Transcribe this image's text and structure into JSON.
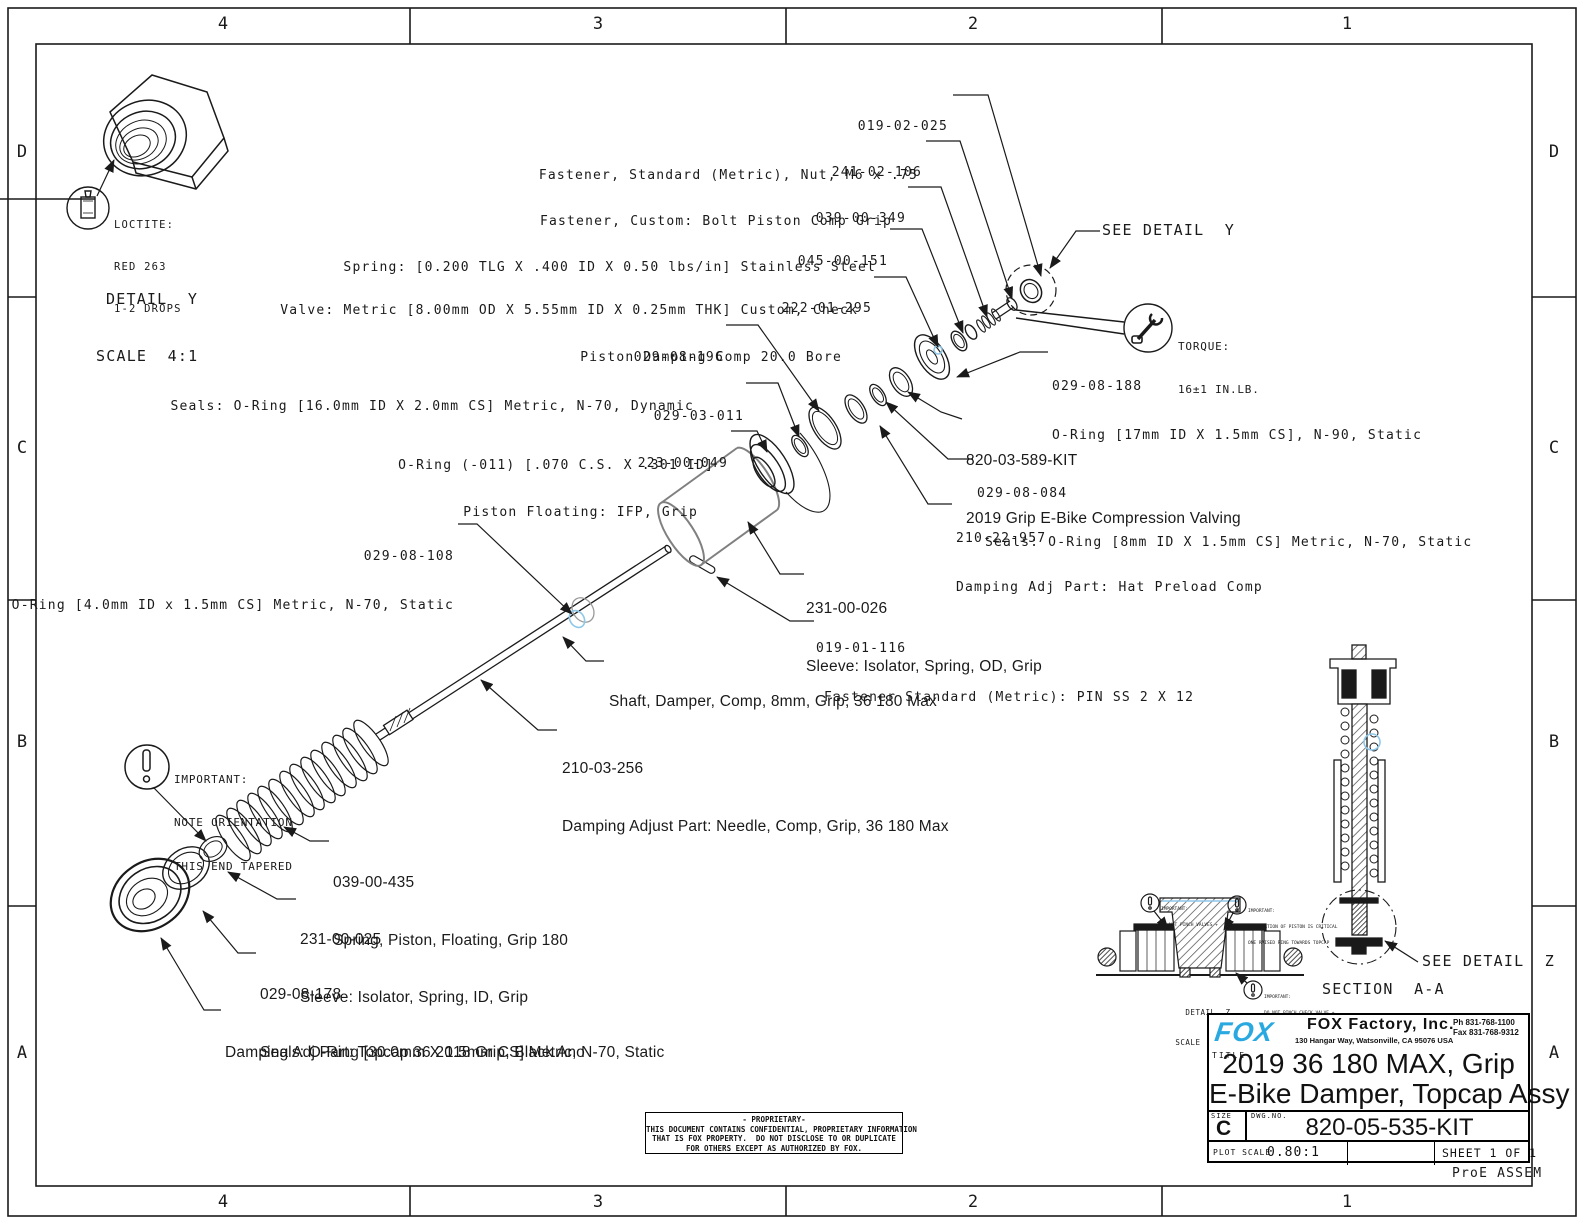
{
  "sheet": {
    "zone_columns": [
      "4",
      "3",
      "2",
      "1"
    ],
    "zone_rows": [
      "D",
      "C",
      "B",
      "A"
    ],
    "footer_note": "ProE ASSEM"
  },
  "colors": {
    "fox_blue": "#2aa9e0",
    "highlight_blue": "#8fc7e8",
    "line": "#1a1a1a"
  },
  "callouts": {
    "nut_m6": {
      "num": "019-02-025",
      "desc": "Fastener, Standard (Metric), Nut, M6 x .75"
    },
    "bolt_piston": {
      "num": "241-02-106",
      "desc": "Fastener, Custom: Bolt Piston Comp Grip"
    },
    "spring_check": {
      "num": "039-00-349",
      "desc": "Spring: [0.200 TLG X .400 ID X 0.50 lbs/in] Stainless Steel"
    },
    "valve_check": {
      "num": "045-00-151",
      "desc": "Valve: Metric [8.00mm OD X 5.55mm ID X 0.25mm THK] Custom, Check"
    },
    "piston_damping": {
      "num": "222-01-295",
      "desc": "Piston Damping Comp 20.0 Bore"
    },
    "oring_16": {
      "num": "029-08-196",
      "desc": "Seals: O-Ring [16.0mm ID X 2.0mm CS] Metric, N-70, Dynamic"
    },
    "oring_011": {
      "num": "029-03-011",
      "desc": "O-Ring (-011) [.070 C.S. X .301 ID]"
    },
    "piston_floating": {
      "num": "223-00-049",
      "desc": "Piston Floating: IFP, Grip"
    },
    "oring_17": {
      "num": "029-08-188",
      "desc": "O-Ring [17mm ID X 1.5mm CS], N-90, Static"
    },
    "comp_valving": {
      "num": "820-03-589-KIT",
      "desc": "2019 Grip E-Bike Compression Valving"
    },
    "oring_8": {
      "num": "029-08-084",
      "desc": "Seals: O-Ring [8mm ID X 1.5mm CS] Metric, N-70, Static"
    },
    "hat_preload": {
      "num": "210-22-957",
      "desc": "Damping Adj Part: Hat Preload Comp"
    },
    "oring_4": {
      "num": "029-08-108",
      "desc": "Seals: O-Ring [4.0mm ID x 1.5mm CS] Metric, N-70, Static"
    },
    "sleeve_od": {
      "num": "231-00-026",
      "desc": "Sleeve: Isolator, Spring, OD, Grip"
    },
    "pin": {
      "num": "019-01-116",
      "desc": "Fastener Standard (Metric): PIN SS 2 X 12"
    },
    "shaft": {
      "desc": "Shaft, Damper, Comp, 8mm, Grip, 36 180 Max"
    },
    "needle": {
      "num": "210-03-256",
      "desc": "Damping Adjust Part: Needle, Comp, Grip, 36 180 Max"
    },
    "spring_piston": {
      "num": "039-00-435",
      "desc": "Spring, Piston, Floating, Grip 180"
    },
    "sleeve_id": {
      "num": "231-00-025",
      "desc": "Sleeve: Isolator, Spring, ID, Grip"
    },
    "oring_30": {
      "num": "029-08-178",
      "desc": "Seals: O-Ring [30.0mm X 1.5mm CS] Metric, N-70, Static"
    },
    "topcap": {
      "desc": "Damping Adj Part: Topcap 36 2018 Grip, Black Ano"
    }
  },
  "notes": {
    "see_detail_y": "SEE DETAIL  Y",
    "see_detail_z": "SEE DETAIL  Z",
    "section_aa": "SECTION  A-A",
    "torque": {
      "line1": "TORQUE:",
      "line2": "16±1 IN.LB."
    },
    "loctite": {
      "line1": "LOCTITE:",
      "line2": "RED 263",
      "line3": "1-2 DROPS"
    },
    "detail_y": {
      "line1": "DETAIL  Y",
      "line2": "SCALE  4:1"
    },
    "detail_z": {
      "line1": "DETAIL  Z",
      "line2": "SCALE  10.000"
    },
    "important_taper": {
      "line1": "IMPORTANT:",
      "line2": "NOTE ORIENTATION",
      "line3": "THIS END TAPERED"
    },
    "dz_valves": {
      "line1": "IMPORTANT:",
      "line2": "DO NOT PINCH VALVES +"
    },
    "dz_orientation": {
      "line1": "IMPORTANT:",
      "line2": "ORIENTATION OF PISTON IS CRITICAL",
      "line3": "ONE RAISED RING TOWARDS TOPCAP"
    },
    "dz_check": {
      "line1": "IMPORTANT:",
      "line2": "DO NOT PINCH CHECK VALVE +"
    }
  },
  "title_block": {
    "brand": "FOX",
    "company": "FOX Factory, Inc.",
    "address": "130 Hangar Way, Watsonville, CA 95076 USA",
    "phone": "Ph 831-768-1100",
    "fax": "Fax 831-768-9312",
    "title_label": "TITLE",
    "title_line1": "2019 36 180 MAX, Grip",
    "title_line2": "E-Bike Damper, Topcap Assy",
    "size_label": "SIZE",
    "size": "C",
    "dwg_label": "DWG.NO.",
    "dwg_no": "820-05-535-KIT",
    "plot_scale_label": "PLOT SCALE",
    "plot_scale": "0.80:1",
    "sheet": "SHEET 1 OF 1"
  },
  "proprietary": {
    "line1": "- PROPRIETARY-",
    "line2": "THIS DOCUMENT CONTAINS CONFIDENTIAL, PROPRIETARY INFORMATION",
    "line3": "THAT IS FOX PROPERTY.  DO NOT DISCLOSE TO OR DUPLICATE",
    "line4": "FOR OTHERS EXCEPT AS AUTHORIZED BY FOX."
  }
}
